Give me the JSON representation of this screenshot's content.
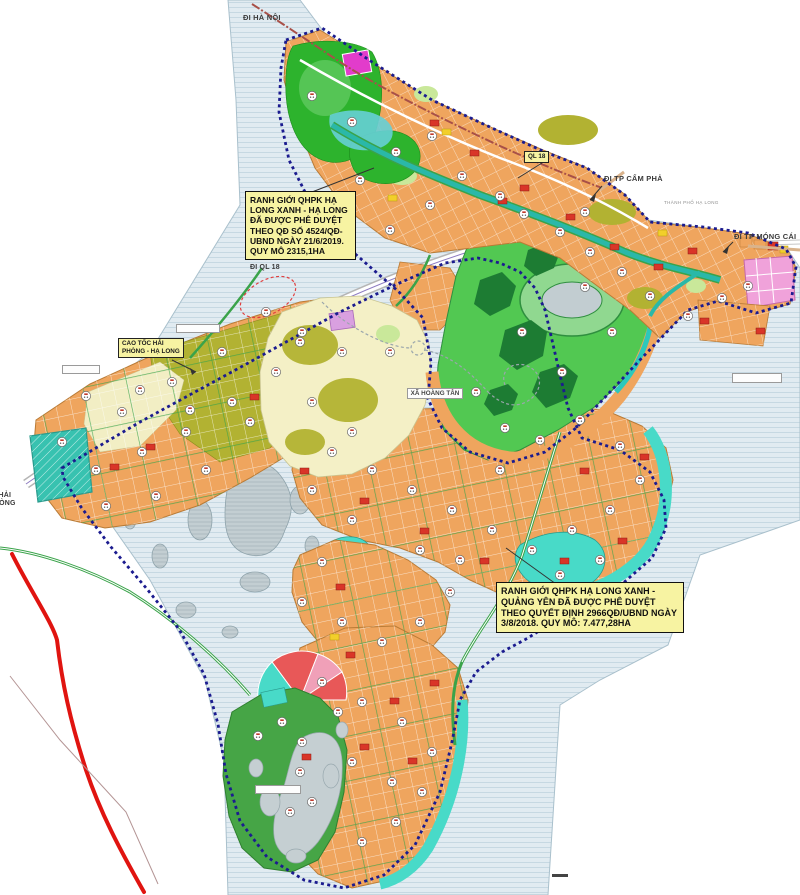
{
  "map": {
    "region_labels": {
      "di_ha_noi": "ĐI HÀ NỘI",
      "di_tp_cam_pha": "ĐI TP CẨM PHẢ",
      "di_tp_mong_cai": "ĐI TP MÓNG CÁI",
      "di_ql_18": "ĐI QL 18",
      "ql_18": "QL 18",
      "cao_toc": "CAO TỐC HẢI PHÒNG - HẠ LONG",
      "di_hai_phong": "ĐI HẢI PHÒNG",
      "xa_hoang_tan": "XÃ HOÀNG TÂN",
      "tp_ha_long": "THÀNH PHỐ HẠ LONG"
    },
    "info_boxes": {
      "ha_long": "RANH GIỚI QHPK HẠ LONG XANH - HẠ LONG ĐÃ ĐƯỢC PHÊ DUYỆT THEO QĐ SỐ 4524/QĐ-UBND NGÀY 21/6/2019. QUY MÔ 2315,1HA",
      "quang_yen": "RANH GIỚI QHPK HẠ LONG XANH - QUẢNG YÊN ĐÃ ĐƯỢC PHÊ DUYỆT THEO QUYẾT ĐỊNH 2966QĐ/UBND NGÀY 3/8/2018. QUY MÔ: 7.477,28HA"
    },
    "colors": {
      "water": "#e1ebf1",
      "residential_orange": "#efa55e",
      "park_green": "#2db32d",
      "golf_green": "#52c852",
      "resort_cyan": "#48dac8",
      "village_olive": "#b2b232",
      "boundary_navy": "#1b1b8f",
      "boundary_red": "#e01410",
      "label_yellow": "#f7f3a2",
      "mixed_magenta": "#e23ccb",
      "commercial_red": "#d93528",
      "tourism_pink": "#f0a2da"
    }
  }
}
